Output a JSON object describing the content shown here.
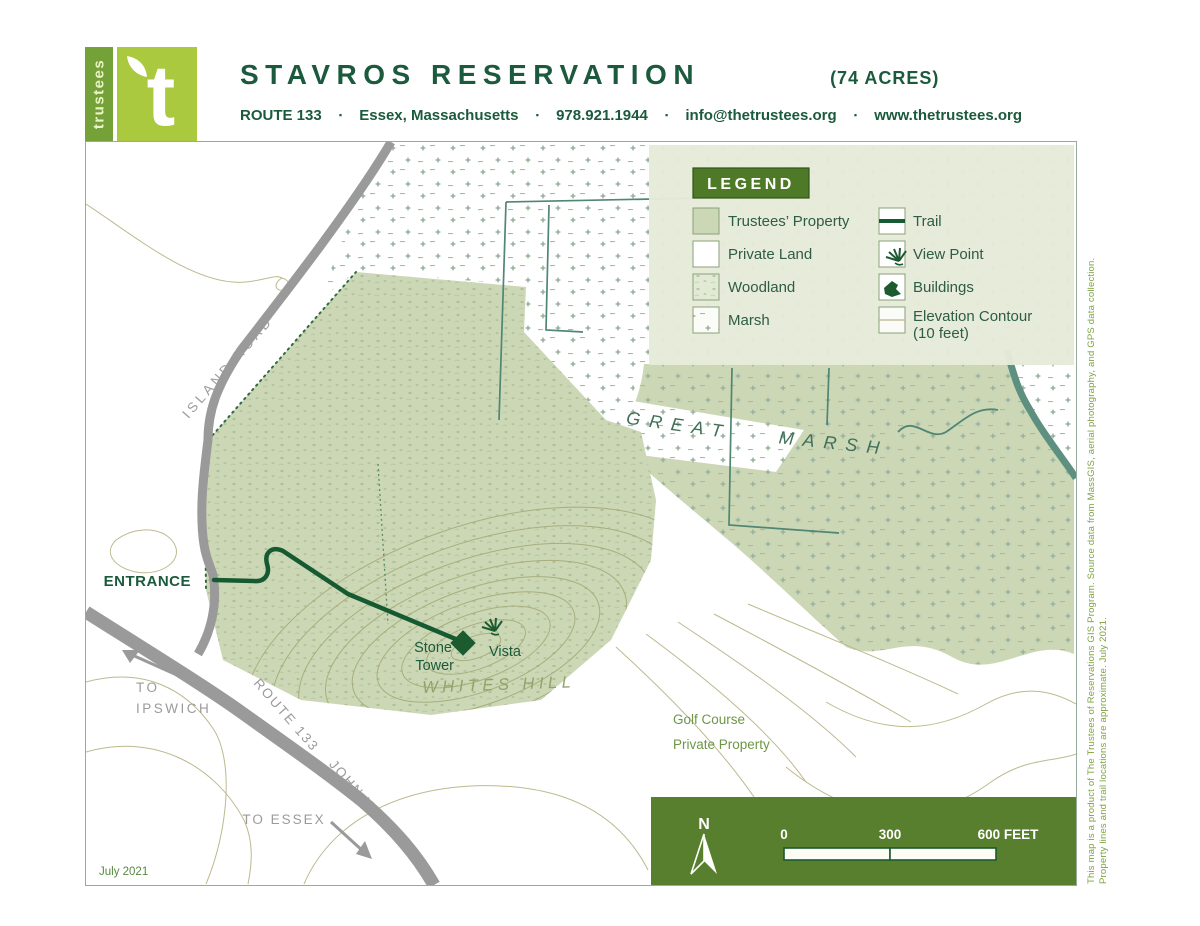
{
  "header": {
    "logo": {
      "vertical_text": "trustees",
      "letter": "t"
    },
    "title": "STAVROS RESERVATION",
    "acres": "(74 ACRES)",
    "contact": {
      "separator": "▪",
      "address": "ROUTE 133",
      "city": "Essex, Massachusetts",
      "phone": "978.921.1944",
      "email": "info@thetrustees.org",
      "website": "www.thetrustees.org"
    }
  },
  "legend": {
    "title": "LEGEND",
    "left_items": [
      "Trustees’ Property",
      "Private Land",
      "Woodland",
      "Marsh"
    ],
    "right_items": [
      "Trail",
      "View Point",
      "Buildings",
      "Elevation Contour"
    ],
    "elevation_note": "(10 feet)"
  },
  "map_labels": {
    "island_road": "ISLAND ROAD",
    "great": "GREAT",
    "marsh": "MARSH",
    "entrance": "ENTRANCE",
    "stone": "Stone",
    "tower": "Tower",
    "vista": "Vista",
    "whites_hill": "WHITES HILL",
    "golf_course": "Golf Course",
    "private_property": "Private Property",
    "to_ipswich_line1": "TO",
    "to_ipswich_line2": "IPSWICH",
    "route_133": "ROUTE 133",
    "john_wise_ave": "JOHN WISE AVE.",
    "to_essex": "TO ESSEX",
    "date": "July 2021"
  },
  "scale_bar": {
    "north": "N",
    "tick_0": "0",
    "tick_300": "300",
    "tick_600": "600 FEET"
  },
  "footnote": {
    "line1": "This map is a product of The Trustees of Reservations GIS Program. Source data from MassGIS, aerial photography, and GPS data collection.",
    "line2": "Property lines and trail locations are approximate.  July 2021."
  },
  "colors": {
    "brand_lime": "#abc93e",
    "brand_green": "#74a238",
    "dark_green_text": "#1b5a3c",
    "trustees_property": "#ccd7b5",
    "legend_bg": "#e6ead9",
    "legend_title_bg": "#4e7a28",
    "scale_panel": "#577f2d",
    "trail": "#155a31",
    "creek": "#4f8674",
    "contour": "#bdb98e",
    "road": "#9a9a9a"
  }
}
